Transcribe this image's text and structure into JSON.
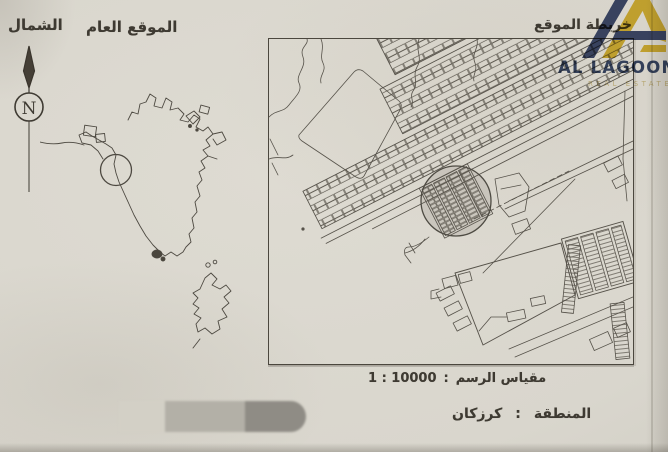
{
  "labels": {
    "north": "الشمال",
    "general_location": "الموقع العام",
    "site_map": "خريطة الموقع"
  },
  "compass": {
    "letter": "N"
  },
  "logo": {
    "title": "AL LAGOON",
    "subtitle": "REAL ESTATE"
  },
  "scale": {
    "label": "مقياس الرسم",
    "separator": ":",
    "value": "1 : 10000"
  },
  "region": {
    "label": "المنطقة",
    "separator": ":",
    "value": "كرزكان"
  },
  "colors": {
    "paper": "#d9d6cd",
    "ink": "#3e3a32",
    "map_line": "#56524a",
    "logo_navy": "#2e3f66",
    "logo_gold": "#e0ba2b"
  }
}
